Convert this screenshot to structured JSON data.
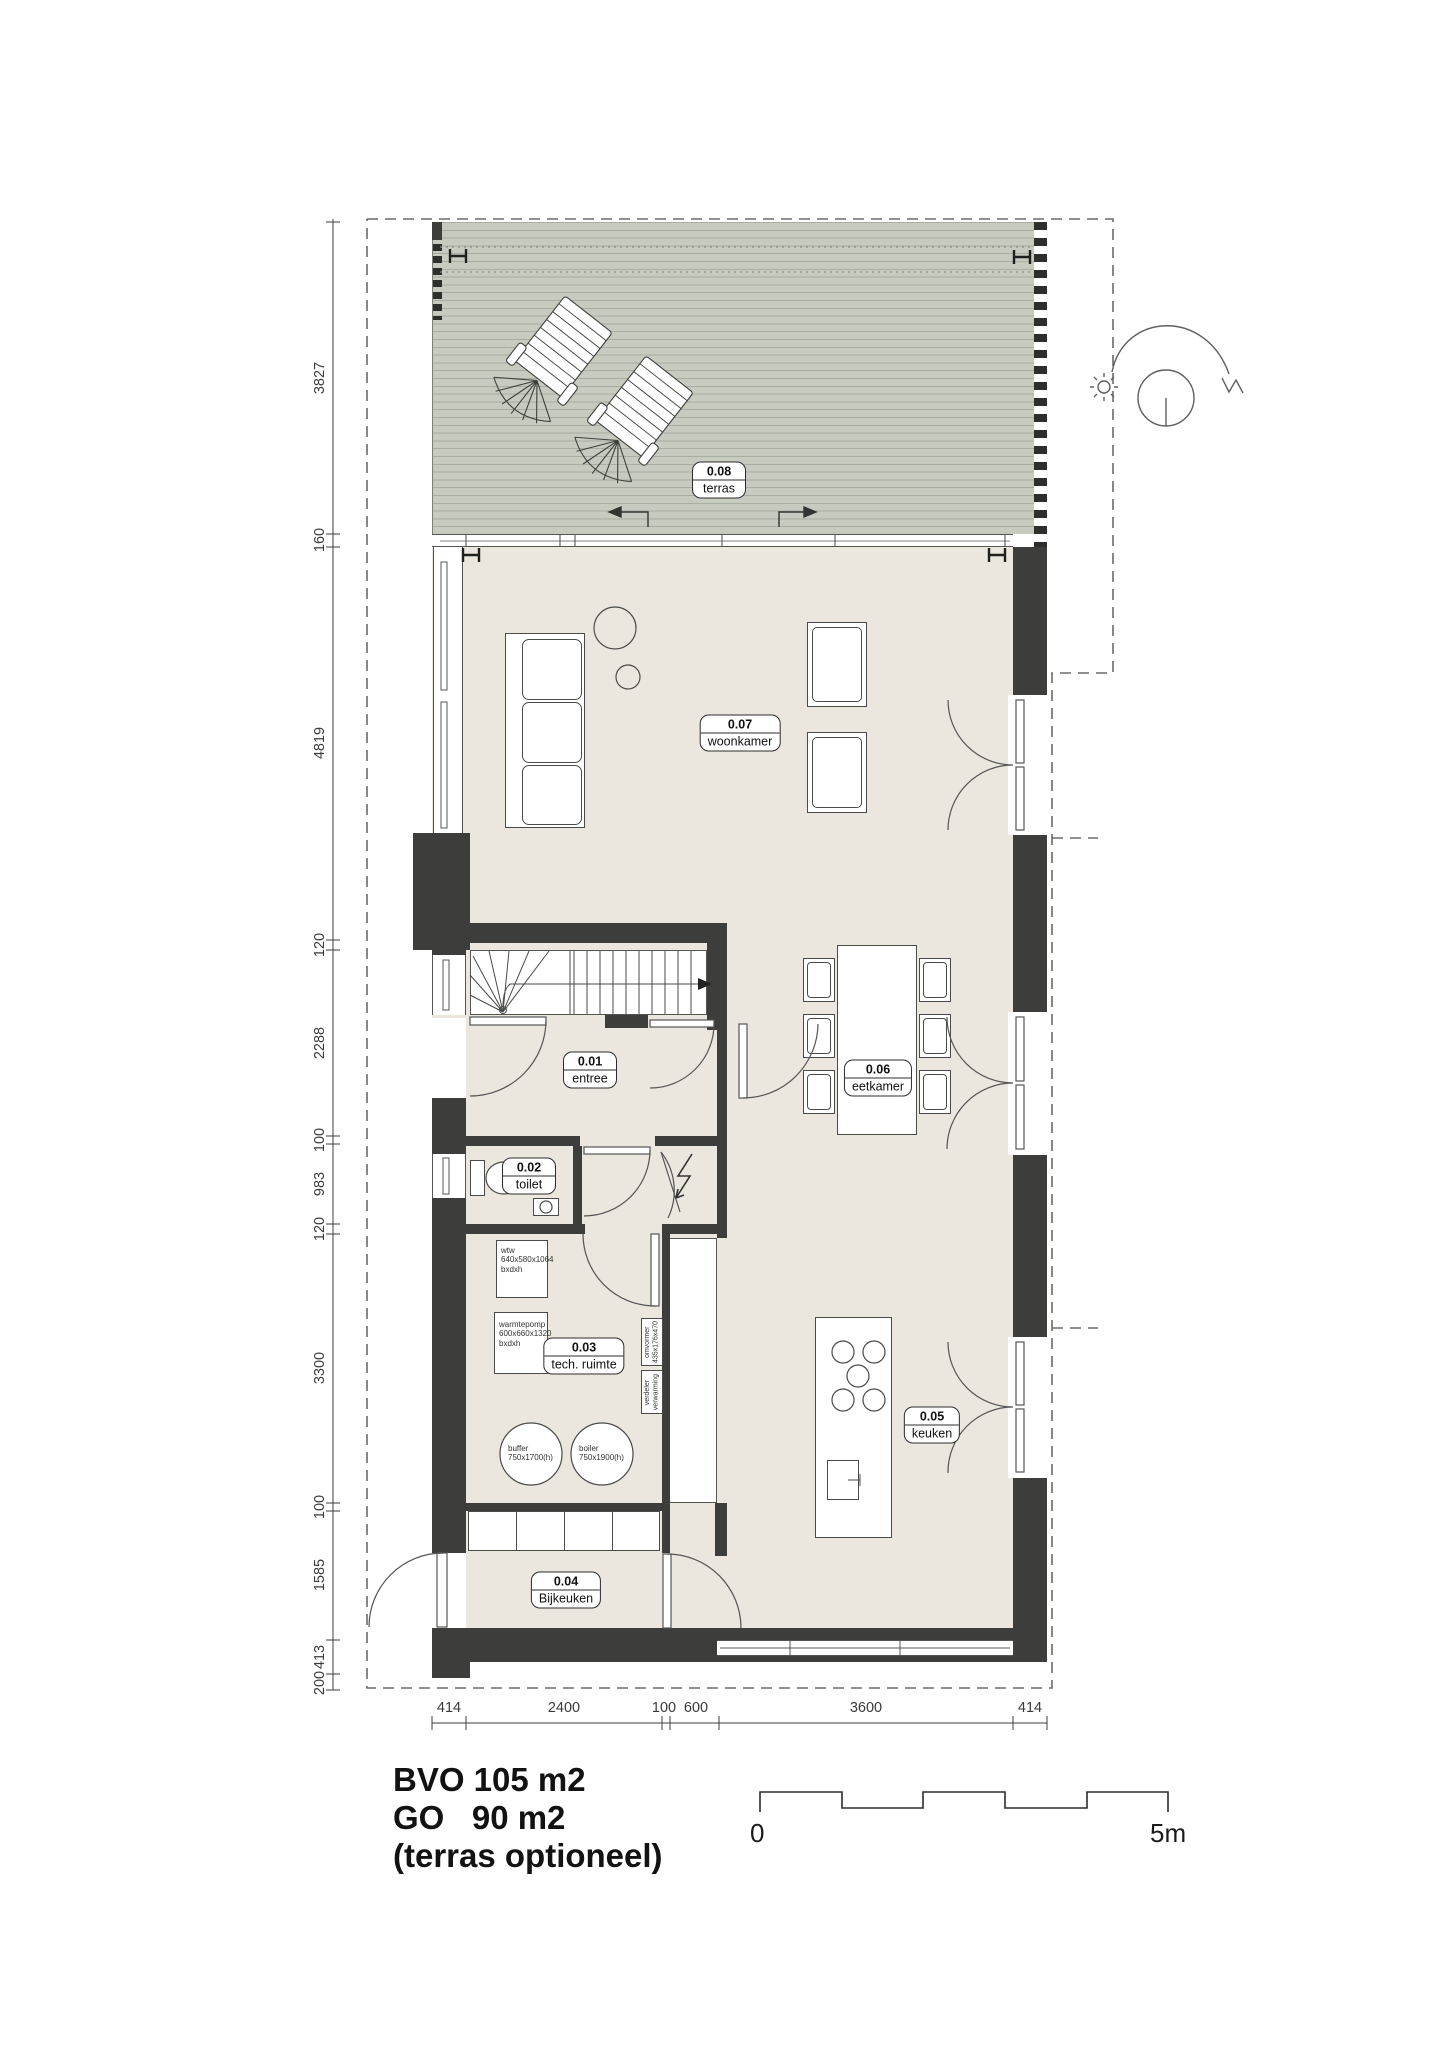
{
  "rooms": {
    "terras": {
      "number": "0.08",
      "name": "terras"
    },
    "woonkamer": {
      "number": "0.07",
      "name": "woonkamer"
    },
    "entree": {
      "number": "0.01",
      "name": "entree"
    },
    "toilet": {
      "number": "0.02",
      "name": "toilet"
    },
    "tech_ruimte": {
      "number": "0.03",
      "name": "tech. ruimte"
    },
    "eetkamer": {
      "number": "0.06",
      "name": "eetkamer"
    },
    "keuken": {
      "number": "0.05",
      "name": "keuken"
    },
    "bijkeuken": {
      "number": "0.04",
      "name": "Bijkeuken"
    }
  },
  "dims": {
    "left": [
      "3827",
      "160",
      "4819",
      "120",
      "2288",
      "100",
      "983",
      "120",
      "3300",
      "100",
      "1585",
      "413",
      "200"
    ],
    "bottom": [
      "414",
      "2400",
      "100",
      "600",
      "3600",
      "414"
    ]
  },
  "equipment": {
    "wtw": {
      "l1": "wtw",
      "l2": "640x580x1064",
      "l3": "bxdxh"
    },
    "warmtepomp": {
      "l1": "warmtepomp",
      "l2": "600x660x1320",
      "l3": "bxdxh"
    },
    "omvormer": {
      "l1": "omvormer",
      "l2": "435x176x470"
    },
    "verdeler": {
      "l1": "verdeler",
      "l2": "verwarming"
    },
    "buffer": {
      "l1": "buffer",
      "l2": "750x1700(h)"
    },
    "boiler": {
      "l1": "boiler",
      "l2": "750x1900(h)"
    }
  },
  "summary": {
    "bvo": "BVO 105 m2",
    "go": "GO   90 m2",
    "note": "(terras optioneel)"
  },
  "scalebar": {
    "start": "0",
    "end": "5m"
  },
  "colors": {
    "wall": "#3d3d3b",
    "floor": "#ebe6de",
    "deck": "#c7cbbf",
    "line": "#4a4a48"
  }
}
